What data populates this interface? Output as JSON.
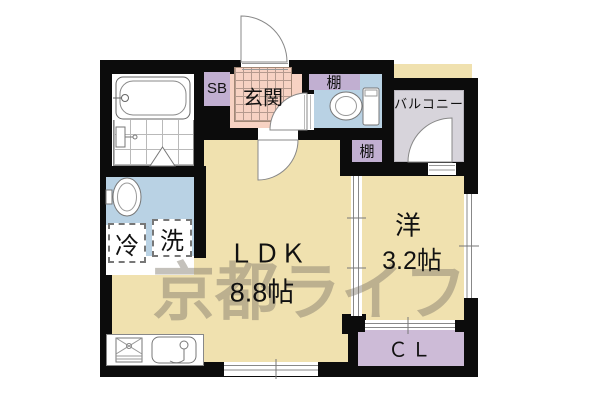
{
  "watermark": "京都ライフ",
  "rooms": {
    "ldk": {
      "label": "ＬＤＫ",
      "size": "8.8帖"
    },
    "western_room": {
      "label": "洋",
      "size": "3.2帖"
    },
    "entrance": {
      "label": "玄関"
    },
    "balcony": {
      "label": "バルコニー"
    },
    "closet": {
      "label": "ＣＬ"
    },
    "shoe_box": {
      "label": "SB"
    },
    "shelf_upper": {
      "label": "棚"
    },
    "shelf_lower": {
      "label": "棚"
    },
    "refrigerator": {
      "label": "冷"
    },
    "washing_machine": {
      "label": "洗"
    }
  },
  "colors": {
    "room_tan": "#f0e1af",
    "entrance_pink": "#f7d2c3",
    "wet_area_blue": "#b9d2e4",
    "shelf_purple": "#c1afd1",
    "closet_purple": "#cdbbd7",
    "balcony_gray": "#d7d4db",
    "wall_black": "#0c0c0c",
    "watermark_gray": "rgba(125,117,104,0.45)"
  }
}
